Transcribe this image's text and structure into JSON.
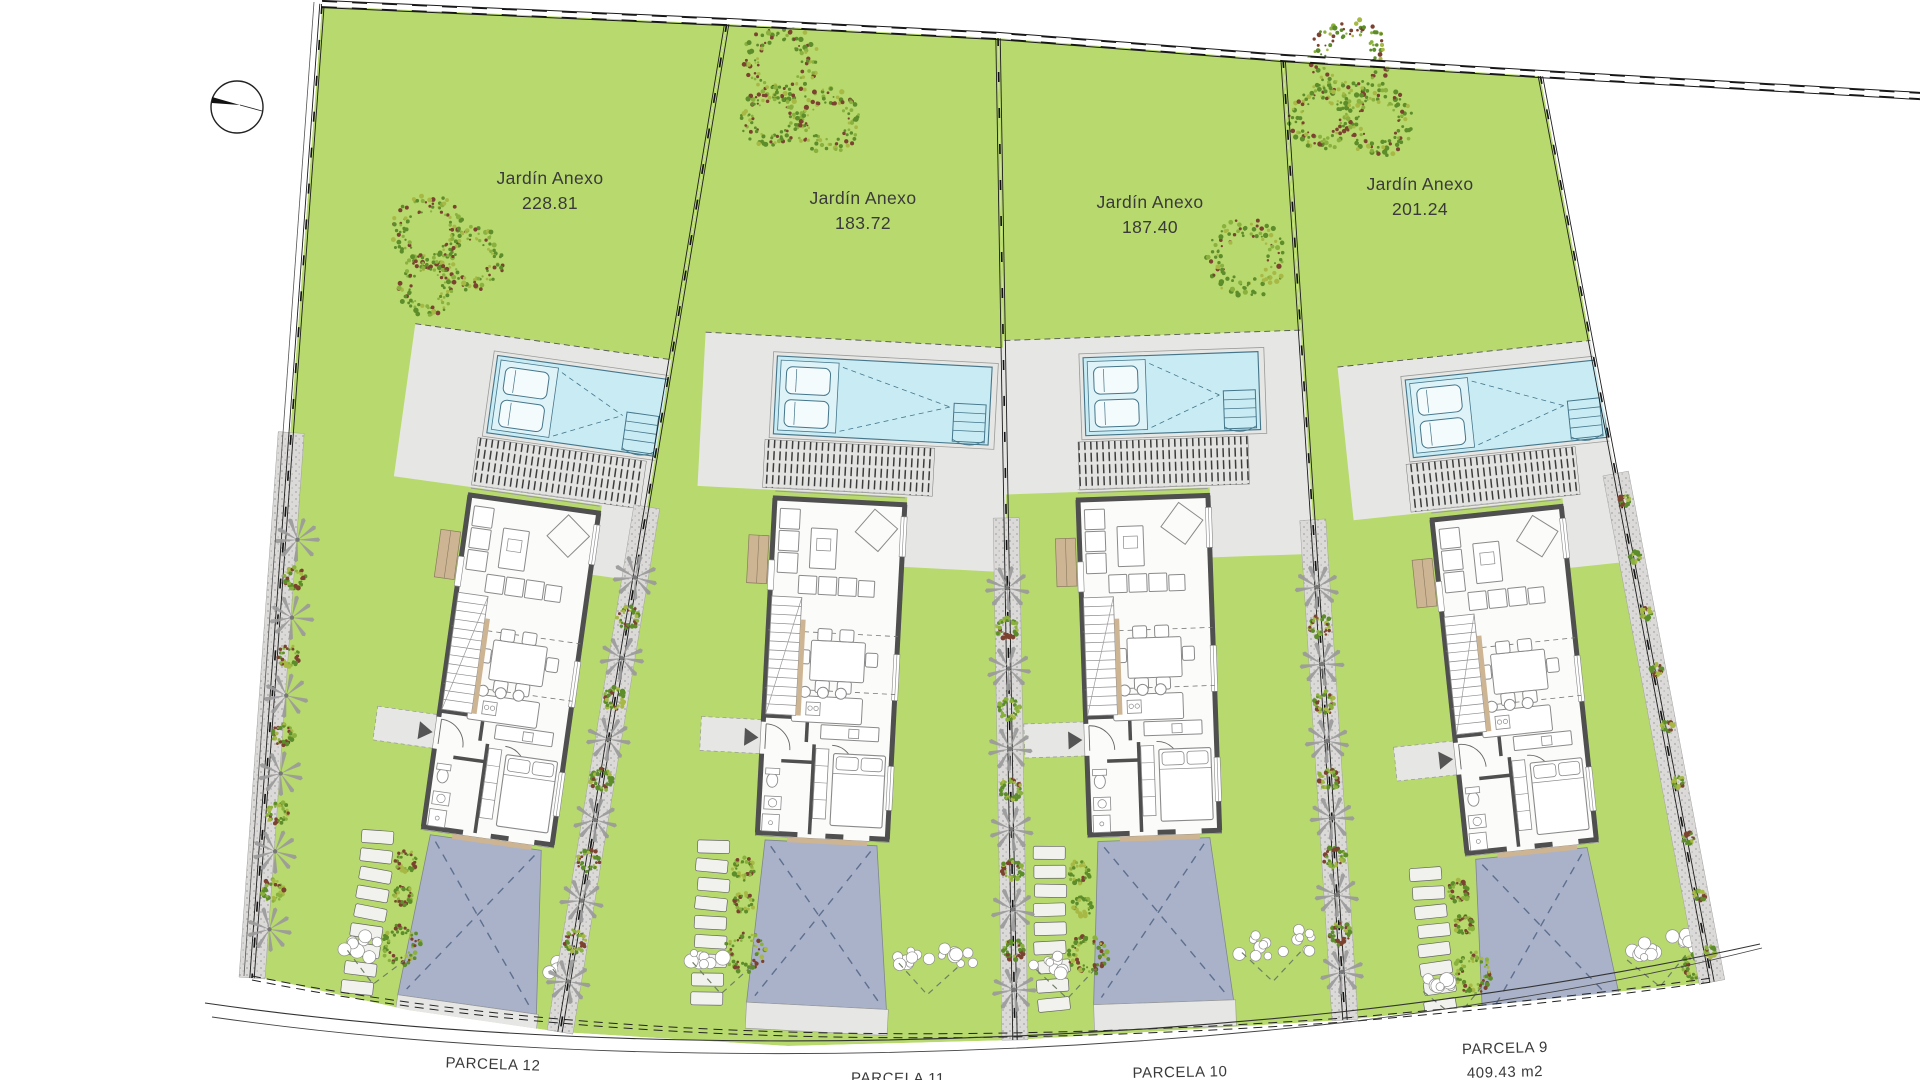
{
  "plan": {
    "garden_label": "Jardín Anexo",
    "parcels": [
      {
        "label": "PARCELA 12",
        "garden_area": "228.81"
      },
      {
        "label": "PARCELA 11",
        "garden_area": "183.72"
      },
      {
        "label": "PARCELA 10",
        "garden_area": "187.40"
      },
      {
        "label": "PARCELA 9",
        "garden_area": "201.24",
        "area_label": "409.43 m2"
      }
    ]
  },
  "colors": {
    "grass": "#b7d96e",
    "terrace": "#e6e6e4",
    "pool_water": "#c9ecf4",
    "pool_platform": "#def3f8",
    "pool_line": "#44758a",
    "driveway": "#a9b2c8",
    "driveway_dash": "#5e6f8e",
    "wall": "#4f4f4f",
    "furniture": "#8a8a8a",
    "tan": "#cdb493",
    "palm": "#9a9a9a",
    "speckle_base": "#dbdad8",
    "speckle_dot": "#a6a6a4",
    "wreath_green": "#5d8c2a",
    "wreath_light": "#8ab03e",
    "wreath_red": "#7c4230",
    "line": "#2a2a2a",
    "text": "#3a3a3a",
    "stone": "#f1f1ee"
  }
}
